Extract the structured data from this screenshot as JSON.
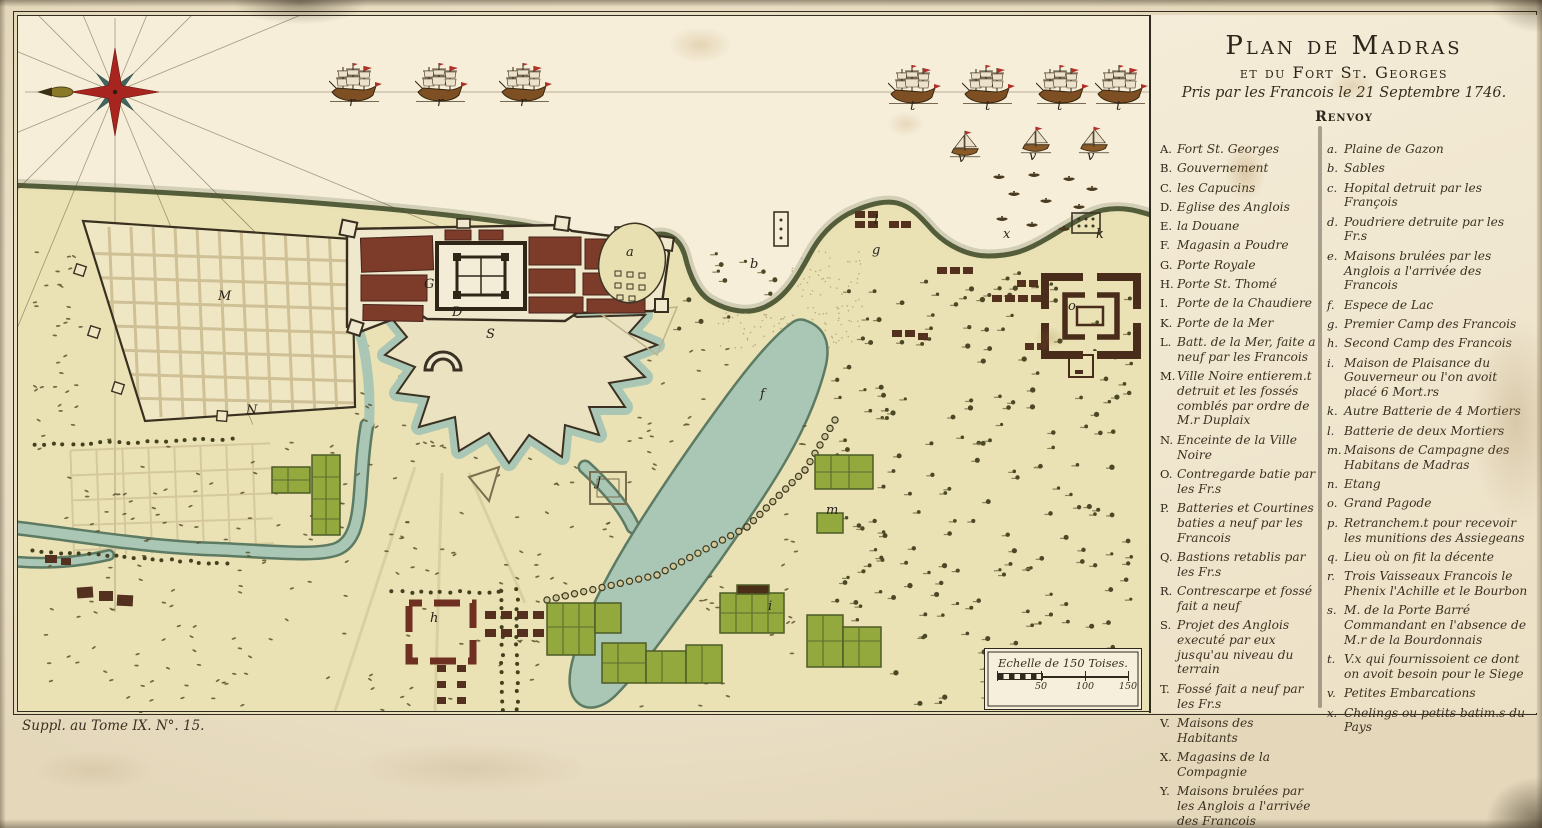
{
  "plate": {
    "title1": "Plan de Madras",
    "title2": "et du Fort St. Georges",
    "title3": "Pris par les Francois le 21 Septembre 1746.",
    "renvoy": "Renvoy",
    "imprint": "Suppl. au Tome IX. N°. 15.",
    "scale_caption": "Echelle de 150 Toises.",
    "scale_ticks": [
      "50",
      "100",
      "150"
    ]
  },
  "legend": {
    "left": [
      {
        "key": "A.",
        "text": "Fort St. Georges"
      },
      {
        "key": "B.",
        "text": "Gouvernement"
      },
      {
        "key": "C.",
        "text": "les Capucins"
      },
      {
        "key": "D.",
        "text": "Eglise des Anglois"
      },
      {
        "key": "E.",
        "text": "la Douane"
      },
      {
        "key": "F.",
        "text": "Magasin a Poudre"
      },
      {
        "key": "G.",
        "text": "Porte Royale"
      },
      {
        "key": "H.",
        "text": "Porte St. Thomé"
      },
      {
        "key": "I.",
        "text": "Porte de la Chaudiere"
      },
      {
        "key": "K.",
        "text": "Porte de la Mer"
      },
      {
        "key": "L.",
        "text": "Batt. de la Mer, faite a neuf par les Francois"
      },
      {
        "key": "M.",
        "text": "Ville Noire entierem.t detruit et les fossés comblés par ordre de M.r Duplaix"
      },
      {
        "key": "N.",
        "text": "Enceinte de la Ville Noire"
      },
      {
        "key": "O.",
        "text": "Contregarde batie par les Fr.s"
      },
      {
        "key": "P.",
        "text": "Batteries et Courtines baties a neuf par les Francois"
      },
      {
        "key": "Q.",
        "text": "Bastions retablis par les Fr.s"
      },
      {
        "key": "R.",
        "text": "Contrescarpe et fossé fait a neuf"
      },
      {
        "key": "S.",
        "text": "Projet des Anglois executé par eux jusqu'au niveau du terrain"
      },
      {
        "key": "T.",
        "text": "Fossé fait a neuf par les Fr.s"
      },
      {
        "key": "V.",
        "text": "Maisons des Habitants"
      },
      {
        "key": "X.",
        "text": "Magasins de la Compagnie"
      },
      {
        "key": "Y.",
        "text": "Maisons brulées par les Anglois a l'arrivée des Francois"
      },
      {
        "key": "Z.",
        "text": "Riviere de Mataron"
      }
    ],
    "right": [
      {
        "key": "a.",
        "text": "Plaine de Gazon"
      },
      {
        "key": "b.",
        "text": "Sables"
      },
      {
        "key": "c.",
        "text": "Hopital detruit par les François"
      },
      {
        "key": "d.",
        "text": "Poudriere detruite par les Fr.s"
      },
      {
        "key": "e.",
        "text": "Maisons brulées par les Anglois a l'arrivée des Francois"
      },
      {
        "key": "f.",
        "text": "Espece de Lac"
      },
      {
        "key": "g.",
        "text": "Premier Camp des Francois"
      },
      {
        "key": "h.",
        "text": "Second Camp des Francois"
      },
      {
        "key": "i.",
        "text": "Maison de Plaisance du Gouverneur ou l'on avoit placé 6 Mort.rs"
      },
      {
        "key": "k.",
        "text": "Autre Batterie de 4 Mortiers"
      },
      {
        "key": "l.",
        "text": "Batterie de deux Mortiers"
      },
      {
        "key": "m.",
        "text": "Maisons de Campagne des Habitans de Madras"
      },
      {
        "key": "n.",
        "text": "Etang"
      },
      {
        "key": "o.",
        "text": "Grand Pagode"
      },
      {
        "key": "p.",
        "text": "Retranchem.t pour recevoir les munitions des Assiegeans"
      },
      {
        "key": "q.",
        "text": "Lieu où on fit la décente"
      },
      {
        "key": "r.",
        "text": "Trois Vaisseaux Francois le Phenix l'Achille et le Bourbon"
      },
      {
        "key": "s.",
        "text": "M. de la Porte Barré Commandant en l'absence de M.r de la Bourdonnais"
      },
      {
        "key": "t.",
        "text": "V.x qui fournissoient ce dont on avoit besoin pour le Siege"
      },
      {
        "key": "v.",
        "text": "Petites Embarcations"
      },
      {
        "key": "x.",
        "text": "Chelings ou petits batim.s du Pays"
      }
    ]
  },
  "map_labels": [
    {
      "char": "r",
      "x": 349,
      "y": 96
    },
    {
      "char": "r",
      "x": 437,
      "y": 96
    },
    {
      "char": "r",
      "x": 520,
      "y": 96
    },
    {
      "char": "t",
      "x": 910,
      "y": 100
    },
    {
      "char": "t",
      "x": 985,
      "y": 100
    },
    {
      "char": "t",
      "x": 1057,
      "y": 100
    },
    {
      "char": "t",
      "x": 1116,
      "y": 100
    },
    {
      "char": "v",
      "x": 958,
      "y": 152
    },
    {
      "char": "v",
      "x": 1029,
      "y": 150
    },
    {
      "char": "v",
      "x": 1087,
      "y": 150
    },
    {
      "char": "x",
      "x": 1003,
      "y": 228
    },
    {
      "char": "a",
      "x": 626,
      "y": 246
    },
    {
      "char": "b",
      "x": 750,
      "y": 258
    },
    {
      "char": "f",
      "x": 760,
      "y": 388
    },
    {
      "char": "M",
      "x": 218,
      "y": 290
    },
    {
      "char": "N",
      "x": 246,
      "y": 404
    },
    {
      "char": "G",
      "x": 424,
      "y": 278
    },
    {
      "char": "D",
      "x": 452,
      "y": 306
    },
    {
      "char": "S",
      "x": 486,
      "y": 328
    },
    {
      "char": "J",
      "x": 596,
      "y": 476
    },
    {
      "char": "h",
      "x": 430,
      "y": 612
    },
    {
      "char": "i",
      "x": 768,
      "y": 600
    },
    {
      "char": "l",
      "x": 874,
      "y": 214
    },
    {
      "char": "g",
      "x": 872,
      "y": 244
    },
    {
      "char": "k",
      "x": 1096,
      "y": 228
    },
    {
      "char": "m",
      "x": 826,
      "y": 504
    },
    {
      "char": "o",
      "x": 1068,
      "y": 300
    }
  ],
  "colors": {
    "paper": "#ece1c8",
    "sea": "#f6eed9",
    "land": "#eae2b4",
    "water": "#a9c7b4",
    "fort_red": "#7d3b2a",
    "garden_green": "#93a93e",
    "compass_red": "#a8241f",
    "ink": "#332c20"
  }
}
